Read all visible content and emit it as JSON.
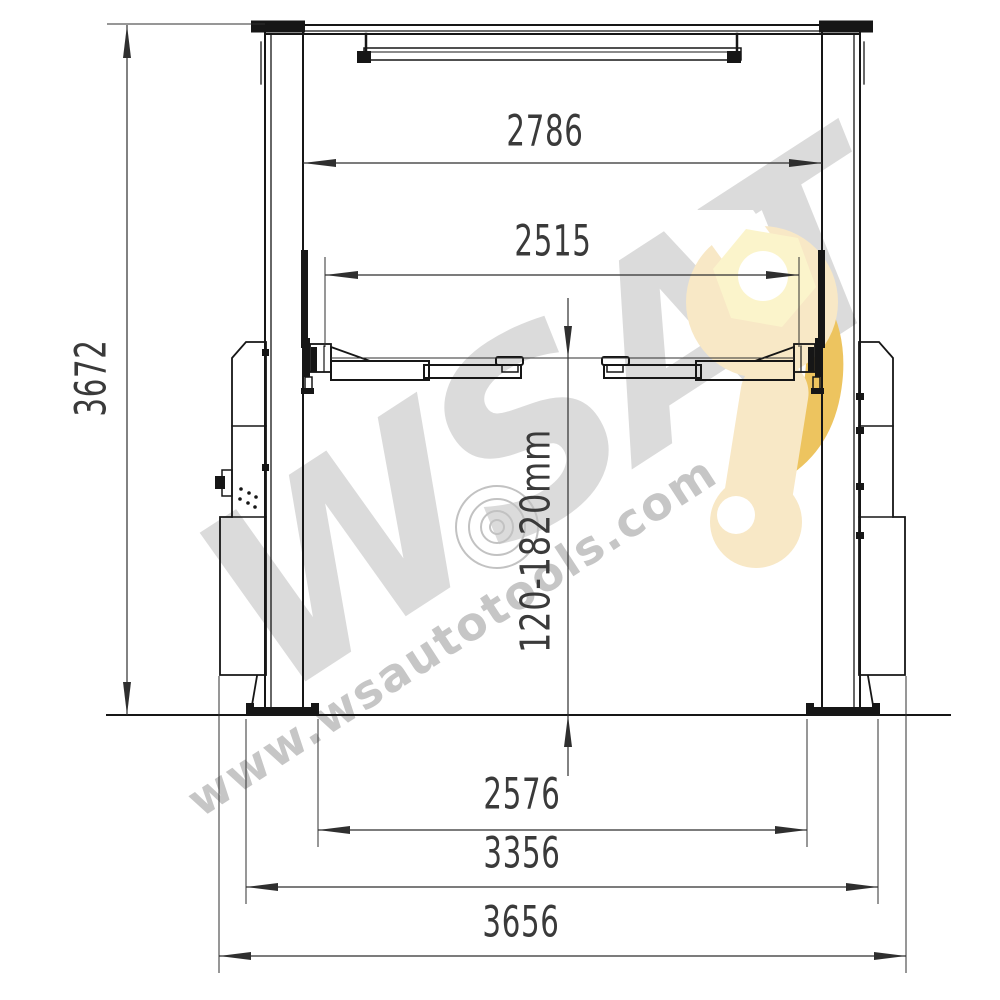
{
  "diagram": {
    "kind": "two-post car lift front-view dimensional drawing"
  },
  "dimensions": {
    "overall_height": "3672",
    "column_span_top": "2786",
    "arm_span": "2515",
    "lift_height_range": "120-1820mm",
    "base_inner_span": "2576",
    "base_outer_span": "3356",
    "overall_width": "3656"
  },
  "watermark": {
    "brand": "WSAT",
    "website": "www.wsautotools.com"
  },
  "icons": {
    "logo": "wrench-with-hex-nut-icon",
    "center_mark": "copyright-swirl-icon"
  },
  "colors": {
    "line": "#161616",
    "dimension_line": "#2f2f2f",
    "dimension_text": "#3a3a3a",
    "watermark_gray": "#dbdbdb",
    "watermark_url_gray": "#c6c6c6",
    "watermark_ring_gray": "#c2c2c2",
    "wrench_body": "#f8e8c6",
    "wrench_accent": "#edc45f",
    "wrench_hex": "#fbf4cb"
  }
}
